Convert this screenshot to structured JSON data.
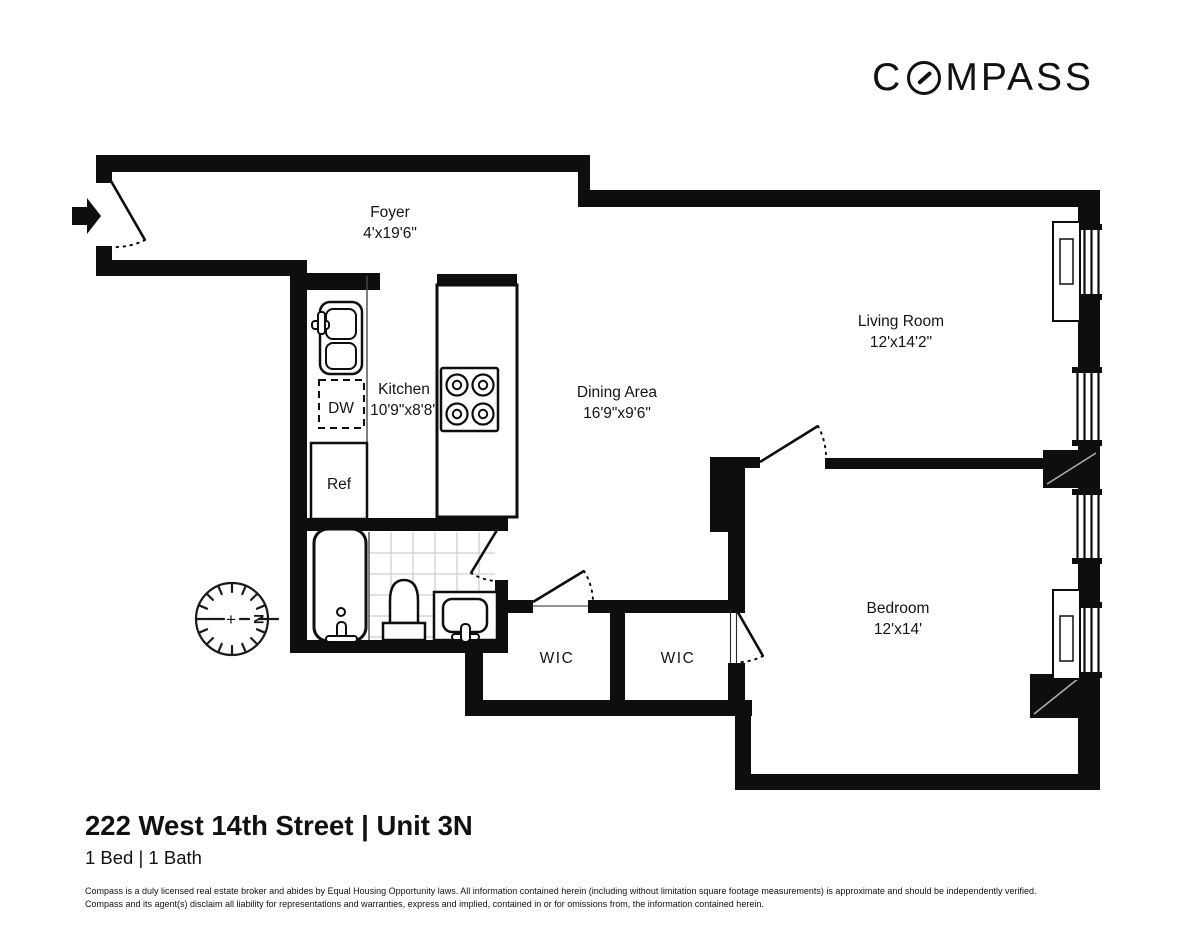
{
  "logo": {
    "first_letter": "C",
    "rest_letters": "MPASS"
  },
  "floorplan": {
    "rooms": {
      "foyer": {
        "name": "Foyer",
        "dims": "4'x19'6\""
      },
      "kitchen": {
        "name": "Kitchen",
        "dims": "10'9\"x8'8\""
      },
      "dining_area": {
        "name": "Dining Area",
        "dims": "16'9\"x9'6\""
      },
      "living_room": {
        "name": "Living Room",
        "dims": "12'x14'2\""
      },
      "bedroom": {
        "name": "Bedroom",
        "dims": "12'x14'"
      },
      "wic_left": {
        "name": "WIC"
      },
      "wic_right": {
        "name": "WIC"
      }
    },
    "appliances": {
      "dishwasher_label": "DW",
      "refrigerator_label": "Ref"
    },
    "compass_rose": {
      "north_label": "N",
      "center_symbol": "+"
    }
  },
  "footer": {
    "title": "222 West 14th Street | Unit 3N",
    "subtitle": "1 Bed | 1 Bath",
    "disclaimer_line1": "Compass is a duly licensed real estate broker and abides by Equal Housing Opportunity laws.  All information contained herein (including without limitation square footage measurements) is approximate and should be independently verified.",
    "disclaimer_line2": "Compass and its agent(s) disclaim all liability for representations and warranties, express and implied, contained in or for omissions from, the information contained herein."
  },
  "colors": {
    "wall": "#0e0e0e",
    "text": "#141414",
    "tile_line": "#cfcfcf"
  }
}
